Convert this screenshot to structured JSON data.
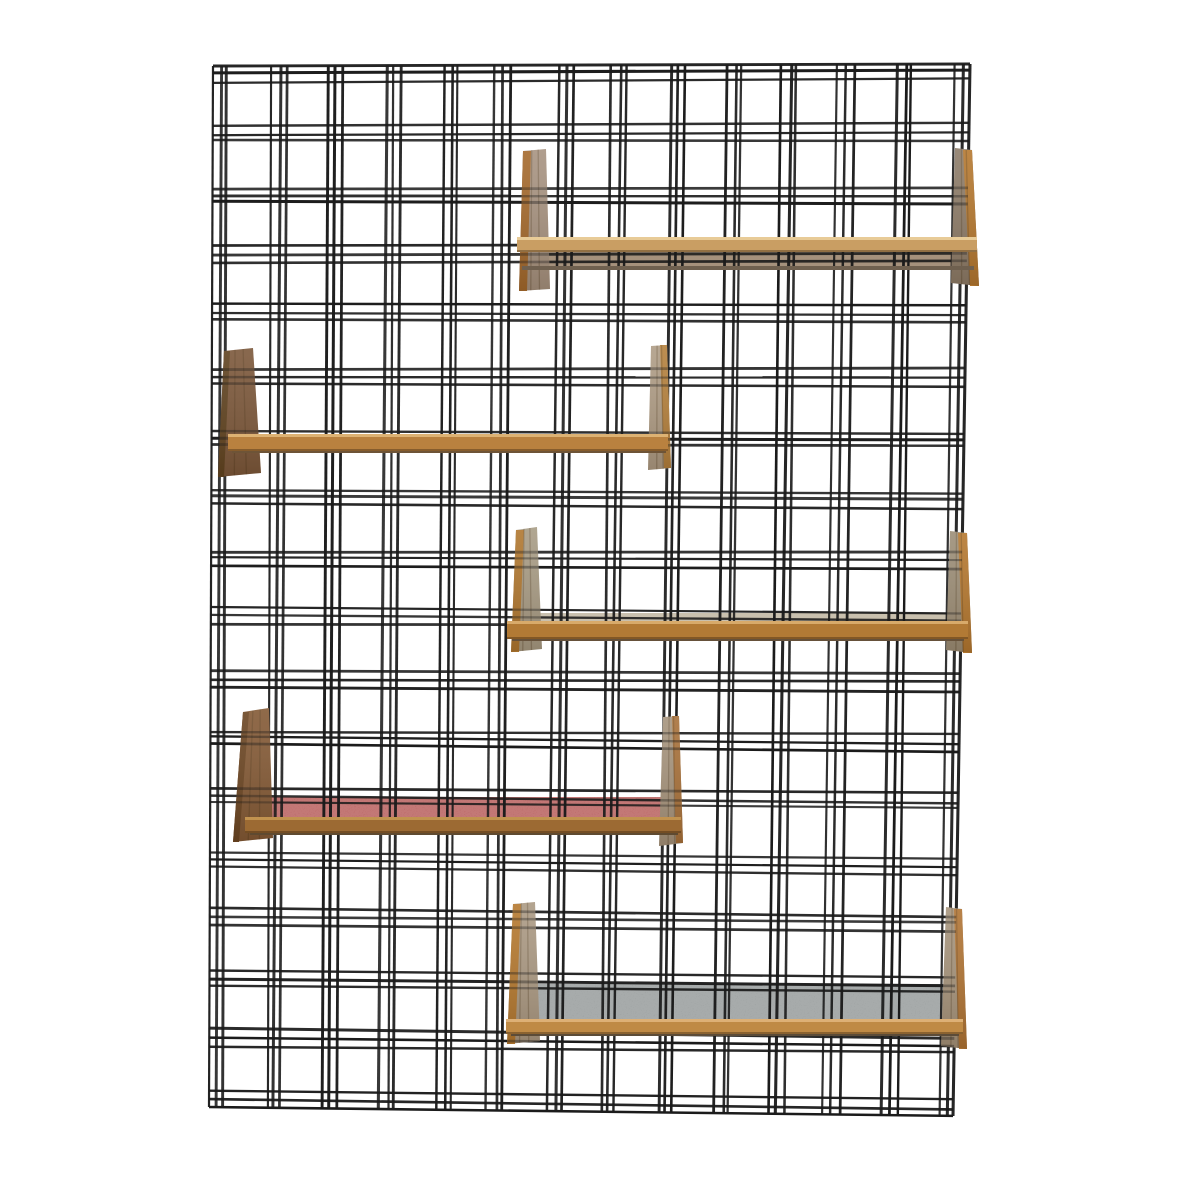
{
  "meta": {
    "aria_label": "Product photograph: black wire plaid grid wall panel with five wooden book shelves"
  },
  "canvas": {
    "width": 1178,
    "height": 1178,
    "background": "#ffffff"
  },
  "grid": {
    "corners": {
      "tl": [
        213,
        66
      ],
      "tr": [
        970,
        64
      ],
      "br": [
        953,
        1116
      ],
      "bl": [
        209,
        1107
      ]
    },
    "space": {
      "width": 757,
      "height": 1041
    },
    "vertical": {
      "count": 14,
      "period": 57.08,
      "offsets": [
        0,
        8,
        15
      ]
    },
    "horizontal": {
      "count": 18,
      "period": 60.35,
      "offsets": [
        0,
        8,
        15
      ]
    },
    "wire": {
      "color": "#1b1b1b",
      "width_base": 2.1,
      "width_var": 1.0,
      "jitter": 2.0,
      "cluster_wobble": 2.6
    }
  },
  "effects": {
    "speckle_opacity": 0.22,
    "panel_wire_opacity": 0.38,
    "grain_line_color": "rgba(70,45,18,0.28)",
    "panel_shade_top": "rgba(255,255,255,0.10)",
    "panel_shade_bottom": "rgba(40,24,8,0.18)"
  },
  "shelves": [
    {
      "name": "shelf-1",
      "panels": [
        {
          "side": "left",
          "pts": [
            [
              523,
              151
            ],
            [
              546,
              149
            ],
            [
              550,
              289
            ],
            [
              519,
              291
            ]
          ],
          "face": "#a79381",
          "edge": "#a4692c",
          "edge_w": 8
        },
        {
          "side": "right",
          "pts": [
            [
              955,
              148
            ],
            [
              972,
              150
            ],
            [
              979,
              286
            ],
            [
              951,
              283
            ]
          ],
          "face": "#8d7c69",
          "edge": "#b5782f",
          "edge_w": 9
        }
      ],
      "surface": {
        "x": 523,
        "y": 251,
        "w": 450,
        "h": 17,
        "color": "#a5917c",
        "speckle": false
      },
      "front": {
        "x": 517,
        "y": 237,
        "w": 460,
        "h": 15,
        "color": "#c99e63",
        "hi": "#e8cb97"
      },
      "shadow": {
        "x": 522,
        "y": 266,
        "w": 452,
        "h": 4,
        "color": "#6f604f"
      }
    },
    {
      "name": "shelf-2",
      "panels": [
        {
          "side": "left",
          "pts": [
            [
              224,
              351
            ],
            [
              253,
              348
            ],
            [
              261,
              473
            ],
            [
              218,
              477
            ]
          ],
          "face": "#7b573a",
          "edge": "#5f421f",
          "edge_w": 6
        },
        {
          "side": "right",
          "pts": [
            [
              651,
              346
            ],
            [
              667,
              345
            ],
            [
              671,
              468
            ],
            [
              648,
              470
            ]
          ],
          "face": "#af9d86",
          "edge": "#b5813d",
          "edge_w": 7
        }
      ],
      "surface": null,
      "front": {
        "x": 228,
        "y": 434,
        "w": 440,
        "h": 17,
        "color": "#b9813f",
        "hi": "#ddb273"
      },
      "shadow": {
        "x": 232,
        "y": 449,
        "w": 434,
        "h": 4,
        "color": "#6e5437"
      }
    },
    {
      "name": "shelf-3",
      "panels": [
        {
          "side": "left",
          "pts": [
            [
              516,
              530
            ],
            [
              537,
              527
            ],
            [
              542,
              649
            ],
            [
              511,
              652
            ]
          ],
          "face": "#a89c85",
          "edge": "#b0772f",
          "edge_w": 8
        },
        {
          "side": "right",
          "pts": [
            [
              950,
              531
            ],
            [
              967,
              533
            ],
            [
              972,
              653
            ],
            [
              946,
              650
            ]
          ],
          "face": "#9c8e77",
          "edge": "#b5782f",
          "edge_w": 9
        }
      ],
      "surface": {
        "x": 520,
        "y": 613,
        "w": 440,
        "h": 10,
        "color": "#c9c0ae",
        "speckle": false
      },
      "front": {
        "x": 507,
        "y": 621,
        "w": 461,
        "h": 18,
        "color": "#b27a35",
        "hi": "#d8aa6a"
      },
      "shadow": {
        "x": 512,
        "y": 637,
        "w": 452,
        "h": 4,
        "color": "#66513a"
      }
    },
    {
      "name": "shelf-4",
      "panels": [
        {
          "side": "left",
          "pts": [
            [
              243,
              712
            ],
            [
              269,
              708
            ],
            [
              273,
              838
            ],
            [
              233,
              842
            ]
          ],
          "face": "#835935",
          "edge": "#6b4522",
          "edge_w": 6
        },
        {
          "side": "right",
          "pts": [
            [
              663,
              717
            ],
            [
              679,
              716
            ],
            [
              683,
              843
            ],
            [
              659,
              846
            ]
          ],
          "face": "#a6947d",
          "edge": "#a8713a",
          "edge_w": 7
        }
      ],
      "surface": {
        "x": 259,
        "y": 797,
        "w": 412,
        "h": 22,
        "color": "#b25250",
        "speckle": true
      },
      "front": {
        "x": 245,
        "y": 817,
        "w": 436,
        "h": 16,
        "color": "#9c6a33",
        "hi": "#c1924f"
      },
      "shadow": {
        "x": 250,
        "y": 831,
        "w": 428,
        "h": 4,
        "color": "#5f4a30"
      }
    },
    {
      "name": "shelf-5",
      "panels": [
        {
          "side": "left",
          "pts": [
            [
              513,
              904
            ],
            [
              535,
              902
            ],
            [
              540,
              1041
            ],
            [
              507,
              1044
            ]
          ],
          "face": "#ab9a84",
          "edge": "#b5792f",
          "edge_w": 8
        },
        {
          "side": "right",
          "pts": [
            [
              946,
              907
            ],
            [
              962,
              909
            ],
            [
              967,
              1049
            ],
            [
              941,
              1046
            ]
          ],
          "face": "#a6947c",
          "edge": "#b07434",
          "edge_w": 8
        }
      ],
      "surface": {
        "x": 520,
        "y": 984,
        "w": 440,
        "h": 38,
        "color": "#8f9494",
        "speckle": true
      },
      "front": {
        "x": 506,
        "y": 1019,
        "w": 457,
        "h": 15,
        "color": "#bf8a45",
        "hi": "#ddb076"
      },
      "shadow": {
        "x": 511,
        "y": 1032,
        "w": 448,
        "h": 4,
        "color": "#5c4c38"
      }
    }
  ]
}
